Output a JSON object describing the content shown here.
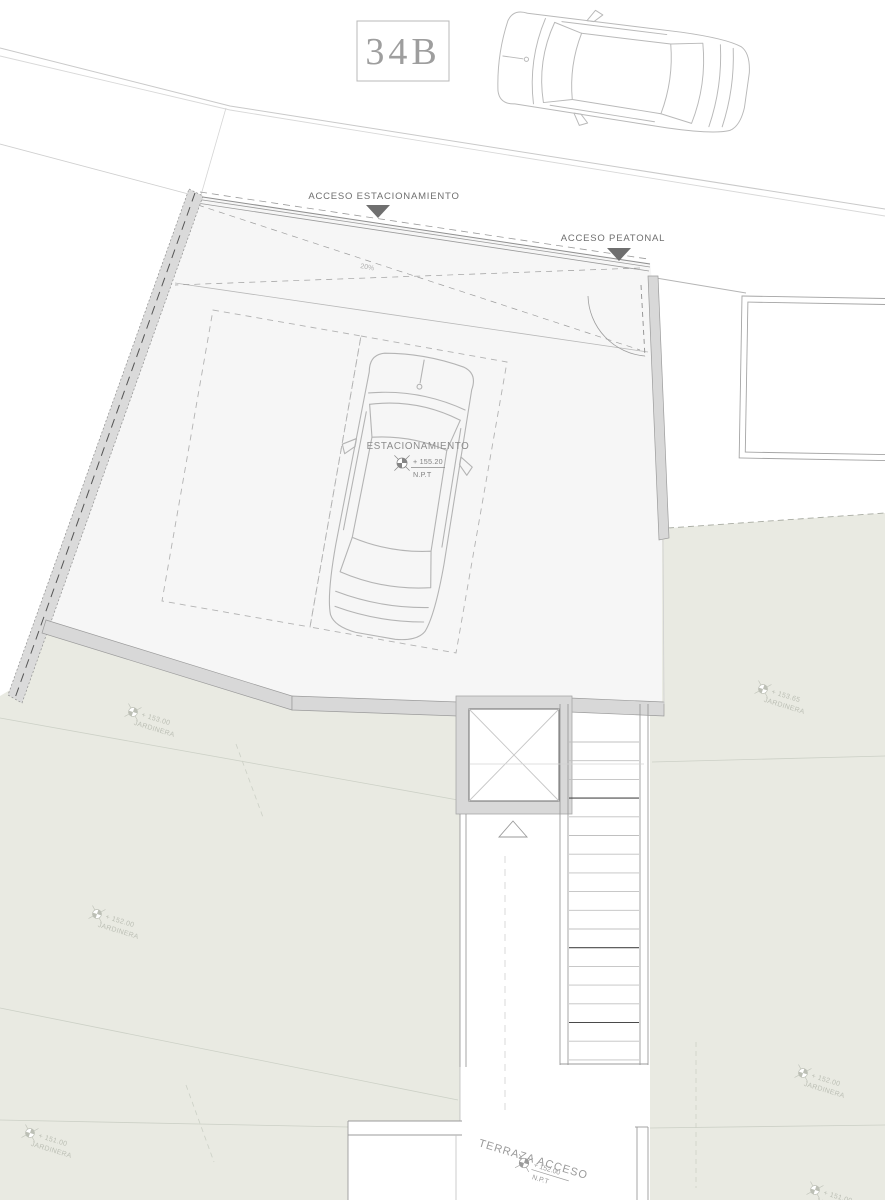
{
  "unit_badge": {
    "label": "34B"
  },
  "annotations": {
    "acceso_estacionamiento": "ACCESO ESTACIONAMIENTO",
    "acceso_peatonal": "ACCESO PEATONAL",
    "ramp_slope": "20%",
    "parking": {
      "title": "ESTACIONAMIENTO",
      "level": "+ 155.20",
      "datum": "N.P.T"
    },
    "terrace": {
      "title": "TERRAZA ACCESO",
      "level": "+ 152.00",
      "datum": "N.P.T"
    }
  },
  "planters": [
    {
      "level": "+ 153.00",
      "label": "JARDINERA"
    },
    {
      "level": "+ 152.00",
      "label": "JARDINERA"
    },
    {
      "level": "+ 153.65",
      "label": "JARDINERA"
    },
    {
      "level": "+ 152.00",
      "label": "JARDINERA"
    },
    {
      "level": "+ 151.00",
      "label": "JARDINERA"
    },
    {
      "level": "+ 151.00",
      "label": "JARDINERA"
    }
  ],
  "colors": {
    "floor": "#f6f6f6",
    "garden": "#e9eae2",
    "wall": "#d8d8d8",
    "label_text": "#6f6f6f",
    "arrow": "#6f6f6f",
    "line_light": "#c9c9c9"
  }
}
